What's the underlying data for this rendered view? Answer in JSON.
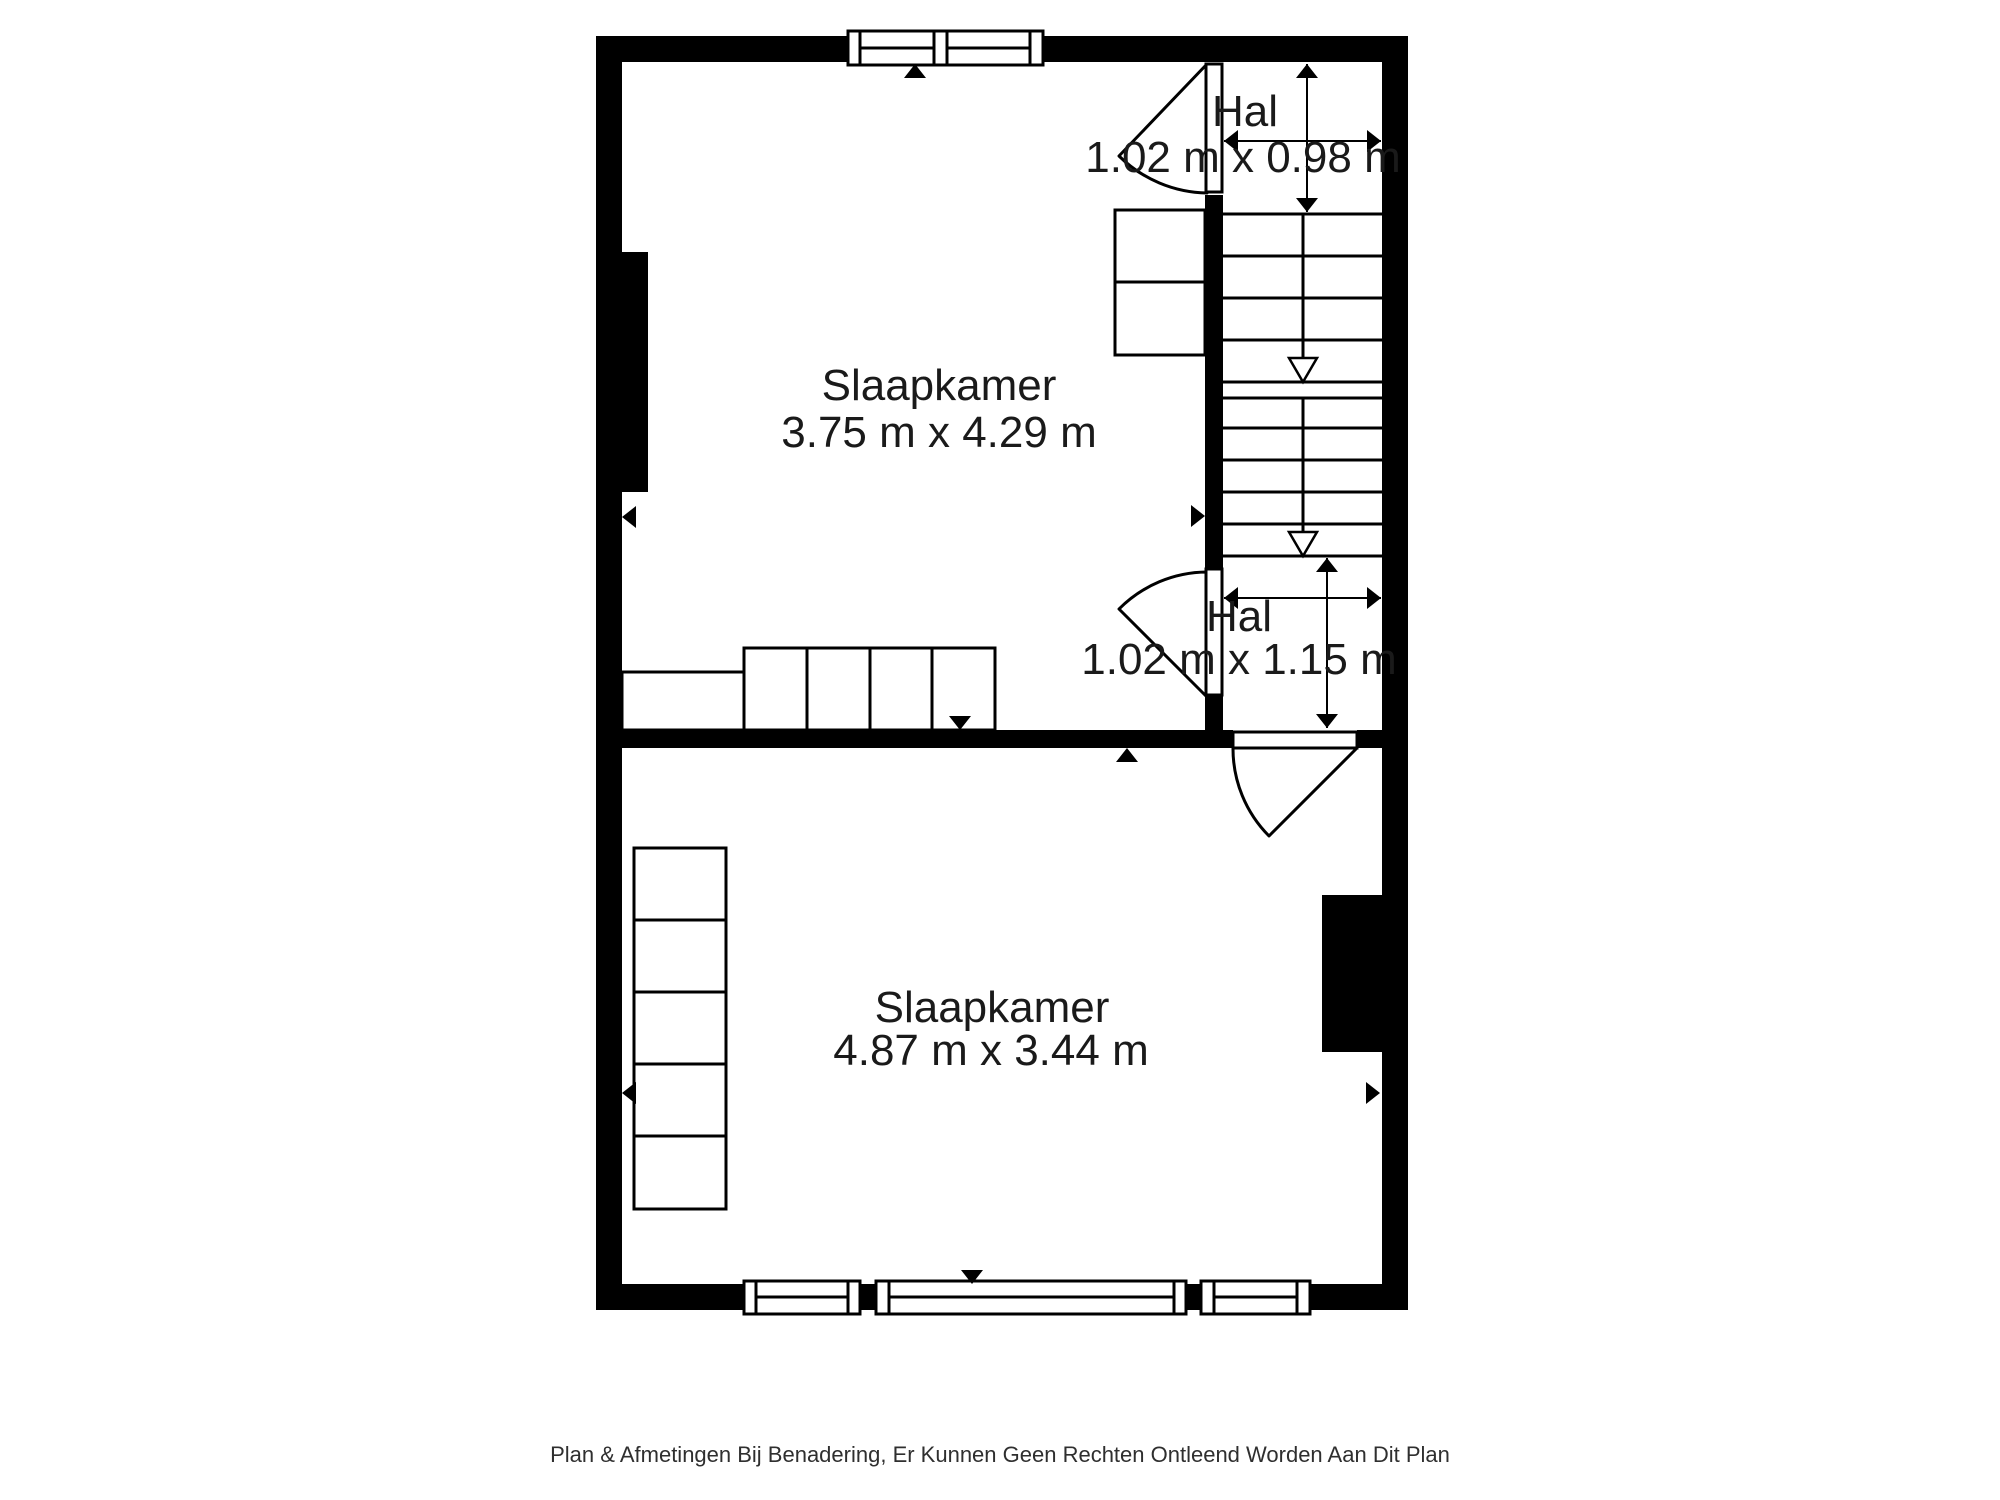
{
  "plan": {
    "rooms": [
      {
        "id": "bedroom-top",
        "label": "Slaapkamer",
        "dimensions": "3.75 m x 4.29 m"
      },
      {
        "id": "hall-top",
        "label": "Hal",
        "dimensions": "1.02 m x 0.98 m"
      },
      {
        "id": "hall-mid",
        "label": "Hal",
        "dimensions": "1.02 m x 1.15 m"
      },
      {
        "id": "bedroom-bottom",
        "label": "Slaapkamer",
        "dimensions": "4.87 m x 3.44 m"
      }
    ],
    "caption": "Plan & Afmetingen Bij Benadering, Er Kunnen Geen Rechten Ontleend Worden Aan Dit Plan",
    "colors": {
      "wall": "#000000",
      "background": "#ffffff",
      "label_text": "#1a1a1a",
      "caption_text": "#2f2f2f"
    }
  }
}
